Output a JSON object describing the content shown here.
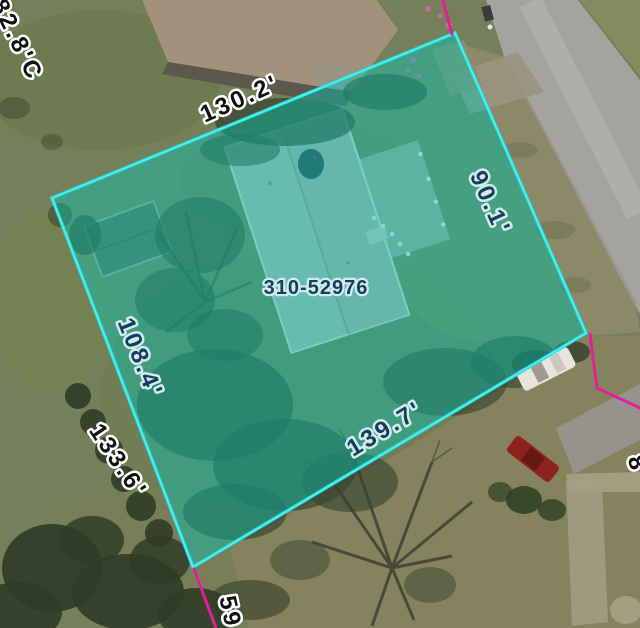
{
  "viewer": {
    "view_type": "aerial-parcel-map",
    "selected_parcel": {
      "id": "310-52976",
      "dimensions": {
        "top_edge_ft": "130.2'",
        "right_edge_ft": "90.1'",
        "left_edge_ft": "108.4'",
        "bottom_edge_ft": "139.7'"
      }
    },
    "neighbor_labels": {
      "top_left": "82.8'C",
      "lower_left": "133.6'",
      "bottom": "59",
      "right": "8"
    },
    "colors": {
      "parcel_outline": "#1FDFE0",
      "parcel_outline_core": "#9FF9F4",
      "parcel_fill": "#00C8B4",
      "neighbor_boundary": "#E02097",
      "inside_label_text": "#1B3A5E",
      "inside_label_halo": "#CDEEE9",
      "outside_label_text": "#111111",
      "outside_label_halo": "#FFFFFF"
    }
  }
}
